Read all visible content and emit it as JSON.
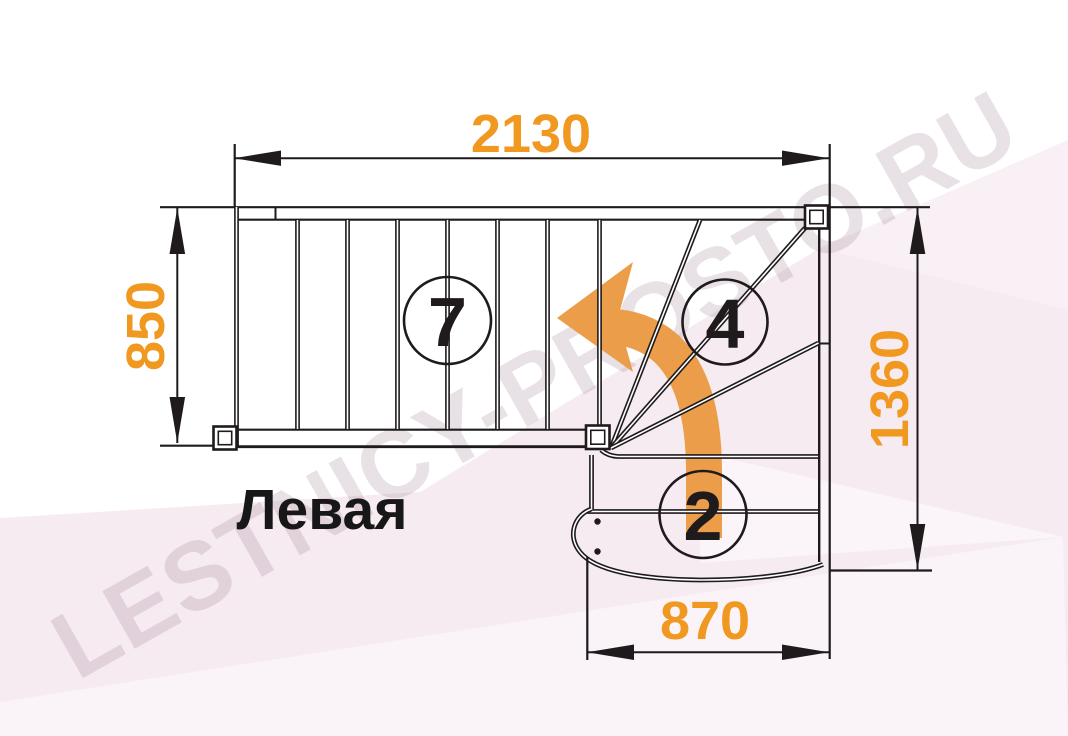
{
  "drawing": {
    "type": "staircase-plan-top-view",
    "orientation_label": "Левая",
    "watermark": "LESTNICY-PROSTO.RU",
    "dimensions": {
      "top_width_mm": "2130",
      "left_height_mm": "850",
      "right_height_mm": "1360",
      "bottom_width_mm": "870"
    },
    "step_counts": {
      "upper_flight": "7",
      "winder": "4",
      "lower_flight": "2"
    },
    "colors": {
      "dimension_text": "#F0981F",
      "direction_arrow": "#EC9D49",
      "line_work": "#1f1b1d",
      "watermark": "#8F6D80",
      "background": "#FFFFFF",
      "facet_pink": "#F6EBF1",
      "facet_pale": "#FAF4F8"
    }
  }
}
